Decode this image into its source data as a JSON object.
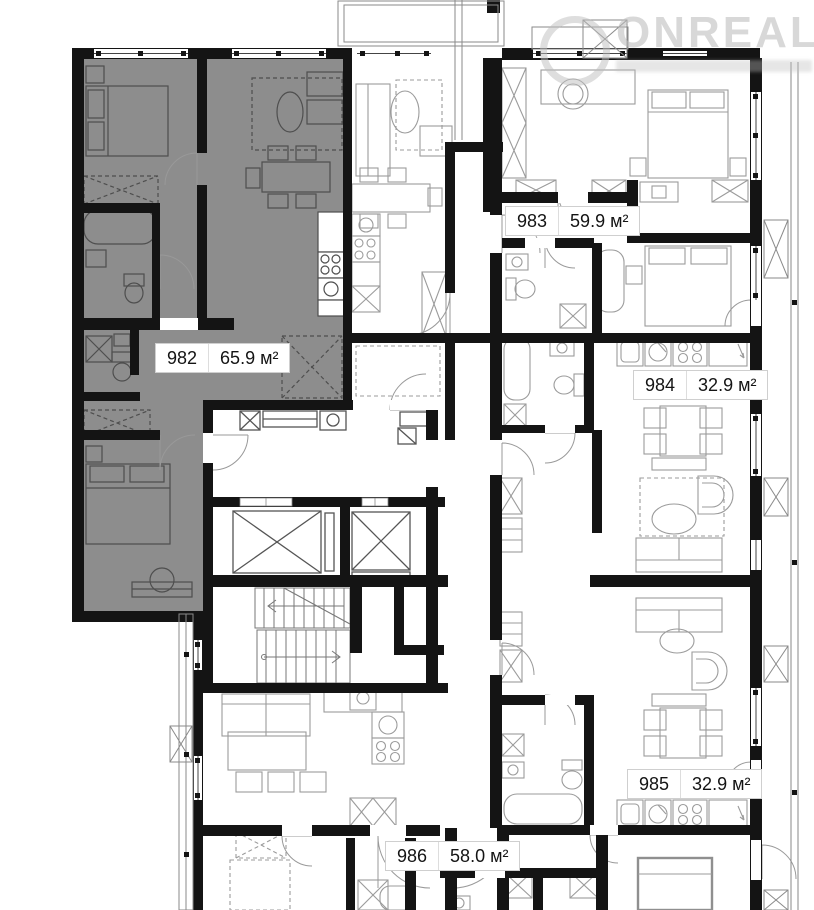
{
  "plan": {
    "title": "Floor plan with apartment areas",
    "apartments": [
      {
        "number": "982",
        "area": "65.9 м²",
        "highlighted": true
      },
      {
        "number": "983",
        "area": "59.9 м²",
        "highlighted": false
      },
      {
        "number": "984",
        "area": "32.9 м²",
        "highlighted": false
      },
      {
        "number": "985",
        "area": "32.9 м²",
        "highlighted": false
      },
      {
        "number": "986",
        "area": "58.0 м²",
        "highlighted": false
      }
    ]
  },
  "watermark": {
    "brand": "ONREALT"
  },
  "colors": {
    "wall": "#141414",
    "highlight": "#8D8D8D",
    "furniture_on_gray": "#4E4E4E",
    "furniture_on_white": "#9B9B9B",
    "railing": "#8a8a8a",
    "label_border": "#CFCFCF",
    "label_text": "#141414",
    "watermark": "#BCBCBC"
  },
  "icons": [
    {
      "name": "elevator-shaft-icon",
      "shape": "crossed-box"
    },
    {
      "name": "staircase-icon",
      "shape": "stair-treads-arrow"
    },
    {
      "name": "wardrobe-icon",
      "shape": "crossed-box"
    },
    {
      "name": "balcony-unit-icon",
      "shape": "crossed-box"
    },
    {
      "name": "stove-icon",
      "shape": "four-burners"
    },
    {
      "name": "sink-icon",
      "shape": "circle-basin"
    }
  ]
}
